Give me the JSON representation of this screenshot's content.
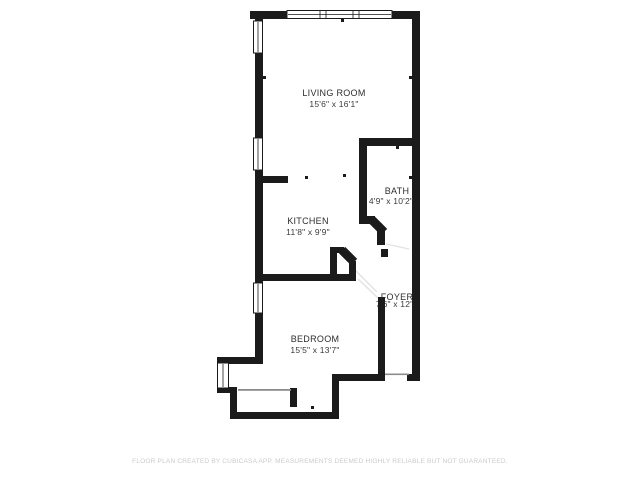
{
  "floor_plan": {
    "rooms": [
      {
        "name": "LIVING ROOM",
        "dims": "15'6\" x 16'1\""
      },
      {
        "name": "BATH",
        "dims": "4'9\" x 10'2\""
      },
      {
        "name": "KITCHEN",
        "dims": "11'8\" x 9'9\""
      },
      {
        "name": "FOYER",
        "dims": "7'6\" x 12'9\""
      },
      {
        "name": "BEDROOM",
        "dims": "15'5\" x 13'7\""
      }
    ],
    "footer": "FLOOR PLAN CREATED BY CUBICASA APP. MEASUREMENTS DEEMED HIGHLY RELIABLE BUT NOT GUARANTEED.",
    "colors": {
      "wall": "#1b1b1b",
      "background": "#ffffff",
      "room_text": "#2d2d2d",
      "footer_text": "#cbcbcb",
      "door_swing": "#e2e2e2"
    }
  }
}
